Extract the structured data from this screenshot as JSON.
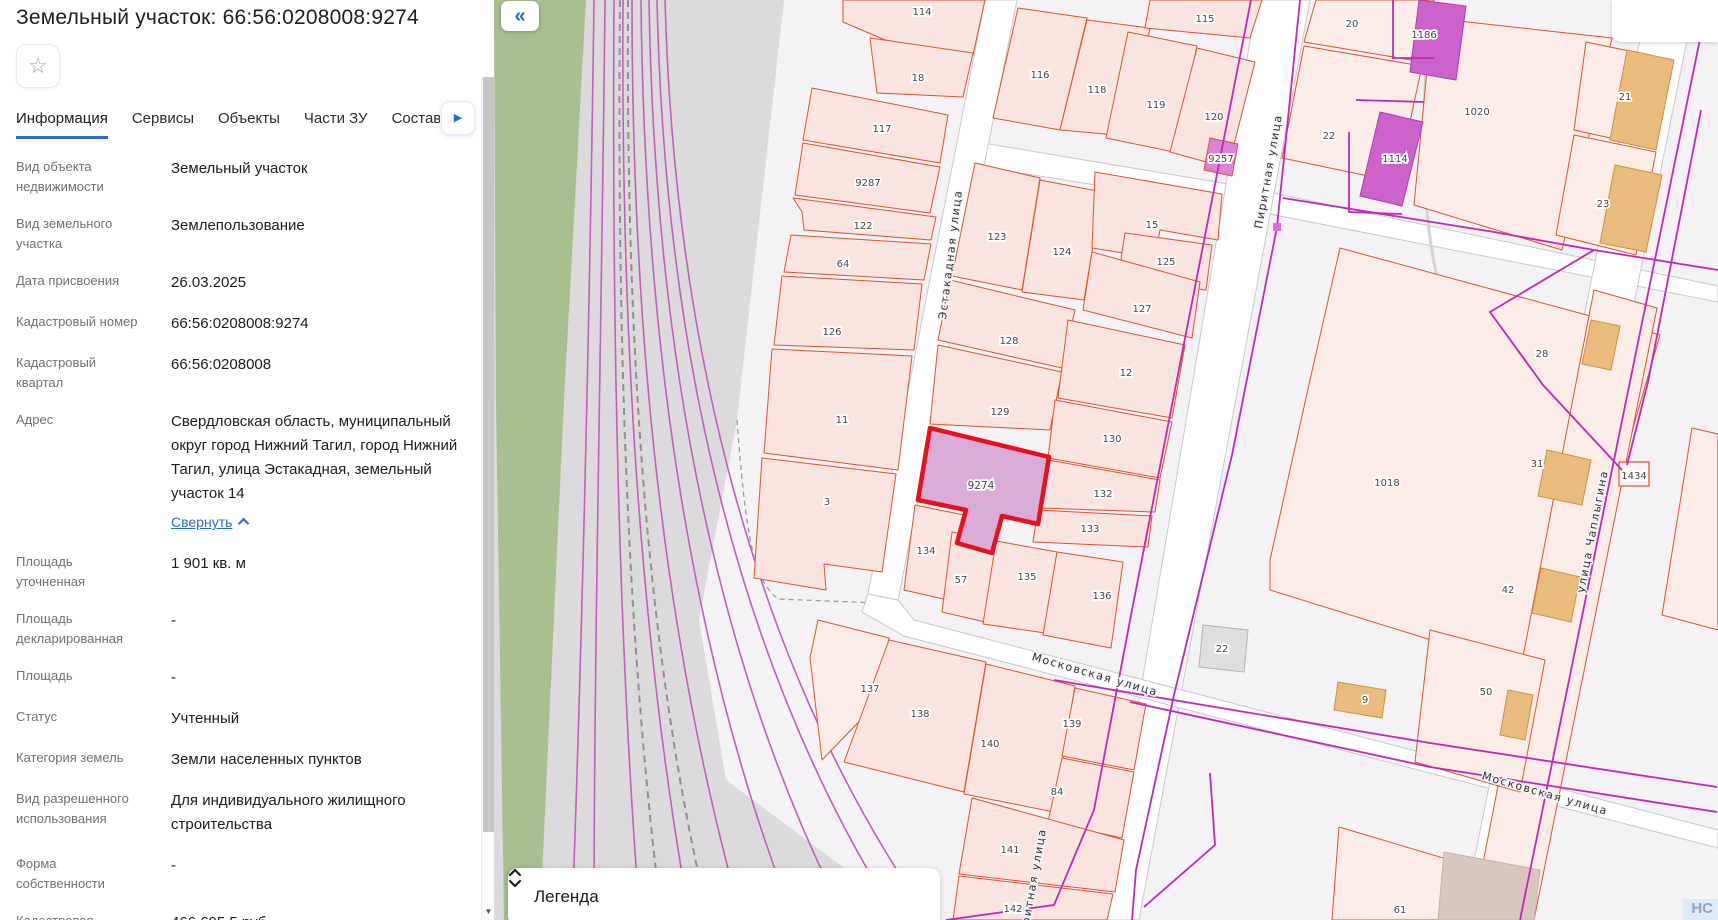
{
  "panel": {
    "title": "Земельный участок: 66:56:0208008:9274",
    "star_icon": "☆",
    "tabs": [
      {
        "label": "Информация",
        "active": true
      },
      {
        "label": "Сервисы",
        "active": false
      },
      {
        "label": "Объекты",
        "active": false
      },
      {
        "label": "Части ЗУ",
        "active": false
      },
      {
        "label": "Состав ЕЗП",
        "active": false
      }
    ],
    "fields": [
      {
        "label": "Вид объекта недвижимости",
        "value": "Земельный участок"
      },
      {
        "label": "Вид земельного участка",
        "value": "Землепользование"
      },
      {
        "label": "Дата присвоения",
        "value": "26.03.2025"
      },
      {
        "label": "Кадастровый номер",
        "value": "66:56:0208008:9274"
      },
      {
        "label": "Кадастровый квартал",
        "value": "66:56:0208008"
      },
      {
        "label": "Адрес",
        "value": "Свердловская область, муниципальный округ город Нижний Тагил, город Нижний Тагил, улица Эстакадная, земельный участок 14",
        "link": "Свернуть"
      },
      {
        "label": "Площадь уточненная",
        "value": "1 901 кв. м"
      },
      {
        "label": "Площадь декларированная",
        "value": "-"
      },
      {
        "label": "Площадь",
        "value": "-"
      },
      {
        "label": "Статус",
        "value": "Учтенный"
      },
      {
        "label": "Категория земель",
        "value": "Земли населенных пунктов"
      },
      {
        "label": "Вид разрешенного использования",
        "value": "Для индивидуального жилищного строительства"
      },
      {
        "label": "Форма собственности",
        "value": "-"
      },
      {
        "label": "Кадастровая стоимость",
        "value": "466 695,5 руб."
      }
    ]
  },
  "map": {
    "collapse_button": "«",
    "legend_title": "Легенда",
    "watermark": "НС",
    "colors": {
      "bg": "#f4f2f4",
      "road": "#ffffff",
      "road_stroke": "#c9c7cc",
      "parcel": "#f9e4e0",
      "parcel_alt": "#fbece7",
      "parcel_stroke": "#e0512f",
      "selected_fill": "#d9abd7",
      "selected_stroke": "#e5111f",
      "magenta_bld": "#ce62cc",
      "magenta_bld_stroke": "#ab3fa9",
      "magenta_parcel": "#d983d7",
      "tan": "#e9bc7e",
      "tan_stroke": "#c8913f",
      "gray_bld": "#dfdfdf",
      "gray_bld_stroke": "#b3b3b3",
      "mauve": "#d9c6c0",
      "mauve_stroke": "#c9b3ac",
      "green": "#a8bf90",
      "rail_area": "#dcdadd",
      "rail": "#c05fb6",
      "rail_dash": "#8f8f8f",
      "utility": "#c227ba",
      "label": "#474747",
      "street_label": "#303030"
    },
    "areas": {
      "rail_corridor": "60,0 290,0 243,420 205,620 232,780 420,920 0,920 0,0",
      "green": "0,0 92,0 70,400 46,920 10,920 2,400"
    },
    "streets": [
      {
        "pts": "489,143 740,185 1224,286 1224,302 740,207 489,167"
      },
      {
        "pts": "491,0 523,0 404,600 374,594"
      },
      {
        "pts": "763,0 816,0 645,920 608,920"
      },
      {
        "pts": "374,594 404,600 420,620 1224,830 1224,848 410,636 368,612"
      },
      {
        "pts": "1154,0 1201,0 1016,920 968,920"
      }
    ],
    "parcels": [
      {
        "n": "114",
        "pts": "349,0 491,0 479,55 391,40 349,22",
        "lx": 428,
        "ly": 12
      },
      {
        "n": "18",
        "pts": "376,38 479,53 469,97 383,93",
        "lx": 424,
        "ly": 78
      },
      {
        "n": "117",
        "pts": "318,88 454,115 446,163 309,140",
        "lx": 388,
        "ly": 129
      },
      {
        "n": "9287",
        "pts": "309,143 446,167 436,213 301,195",
        "lx": 374,
        "ly": 183
      },
      {
        "n": "122",
        "pts": "299,198 442,217 437,240 310,230 308,212",
        "lx": 369,
        "ly": 226
      },
      {
        "n": "64",
        "pts": "297,235 437,244 430,280 290,272",
        "lx": 349,
        "ly": 264
      },
      {
        "n": "126",
        "pts": "288,276 428,284 420,350 280,345",
        "lx": 338,
        "ly": 332
      },
      {
        "n": "11",
        "pts": "278,349 418,356 404,470 270,453",
        "lx": 348,
        "ly": 420
      },
      {
        "n": "3",
        "pts": "268,458 402,474 388,572 330,564 332,590 260,578",
        "lx": 333,
        "ly": 502
      },
      {
        "n": "116",
        "pts": "524,8 593,18 566,130 499,118",
        "lx": 546,
        "ly": 75
      },
      {
        "n": "118",
        "pts": "593,20 656,28 634,136 566,130",
        "lx": 603,
        "ly": 90
      },
      {
        "n": "115",
        "pts": "656,0 768,0 756,38 651,28",
        "lx": 711,
        "ly": 19
      },
      {
        "n": "119",
        "pts": "634,32 703,46 680,152 612,138",
        "lx": 662,
        "ly": 105
      },
      {
        "n": "120",
        "pts": "703,48 761,62 734,168 676,152",
        "lx": 720,
        "ly": 117
      },
      {
        "n": "9257",
        "pts": "716,138 744,144 738,176 710,170",
        "lx": 727,
        "ly": 159,
        "mag": true
      },
      {
        "n": "123",
        "pts": "481,163 546,178 528,290 458,276",
        "lx": 503,
        "ly": 237
      },
      {
        "n": "124",
        "pts": "546,180 608,192 590,300 528,292",
        "lx": 568,
        "ly": 252
      },
      {
        "n": "15",
        "pts": "601,172 728,194 724,240 666,230 661,258 598,248",
        "lx": 658,
        "ly": 225
      },
      {
        "n": "125",
        "pts": "631,233 718,245 712,290 624,278",
        "lx": 672,
        "ly": 262
      },
      {
        "n": "127",
        "pts": "598,252 706,282 698,338 589,310",
        "lx": 648,
        "ly": 309
      },
      {
        "n": "128",
        "pts": "456,280 581,310 568,368 444,340",
        "lx": 515,
        "ly": 341
      },
      {
        "n": "129",
        "pts": "444,345 568,372 556,430 436,424",
        "lx": 506,
        "ly": 412
      },
      {
        "n": "12",
        "pts": "574,320 691,345 678,418 564,398",
        "lx": 632,
        "ly": 373
      },
      {
        "n": "130",
        "pts": "561,400 678,422 666,478 554,458",
        "lx": 618,
        "ly": 439
      },
      {
        "n": "132",
        "pts": "554,460 666,480 661,512 546,508",
        "lx": 609,
        "ly": 494
      },
      {
        "n": "133",
        "pts": "544,510 658,516 654,547 539,542",
        "lx": 596,
        "ly": 529
      },
      {
        "n": "134",
        "pts": "421,505 470,515 458,601 410,590",
        "lx": 432,
        "ly": 551
      },
      {
        "n": "57",
        "pts": "458,532 502,541 491,622 448,612",
        "lx": 467,
        "ly": 580
      },
      {
        "n": "135",
        "pts": "502,541 563,552 551,633 489,624",
        "lx": 533,
        "ly": 577
      },
      {
        "n": "136",
        "pts": "563,552 629,562 617,648 549,635",
        "lx": 608,
        "ly": 596
      },
      {
        "n": "137",
        "pts": "324,620 395,638 384,702 328,760 316,658",
        "lx": 376,
        "ly": 689,
        "alt": true
      },
      {
        "n": "138",
        "pts": "395,640 492,662 470,792 350,762",
        "lx": 426,
        "ly": 714
      },
      {
        "n": "140",
        "pts": "492,664 581,686 560,812 470,794",
        "lx": 496,
        "ly": 744
      },
      {
        "n": "139",
        "pts": "581,688 652,704 640,770 568,756",
        "lx": 578,
        "ly": 724
      },
      {
        "n": "84",
        "pts": "568,758 640,772 628,838 554,822",
        "lx": 563,
        "ly": 792
      },
      {
        "n": "141",
        "pts": "478,798 630,840 621,892 465,874",
        "lx": 516,
        "ly": 850
      },
      {
        "n": "142",
        "pts": "465,876 619,894 613,920 459,920",
        "lx": 519,
        "ly": 909
      },
      {
        "n": "20",
        "pts": "822,0 940,0 929,62 810,42",
        "lx": 858,
        "ly": 24,
        "alt": true
      },
      {
        "n": "22",
        "pts": "810,46 928,66 903,182 788,158",
        "lx": 835,
        "ly": 136,
        "alt": true
      },
      {
        "n": "1020",
        "pts": "938,18 1118,38 1068,250 920,205",
        "lx": 983,
        "ly": 112,
        "alt": true
      },
      {
        "n": "21",
        "pts": "1092,42 1178,60 1162,148 1080,130",
        "lx": 1131,
        "ly": 97,
        "alt": true
      },
      {
        "n": "23",
        "pts": "1080,135 1162,152 1142,255 1062,235",
        "lx": 1109,
        "ly": 204,
        "alt": true
      },
      {
        "n": "1018",
        "pts": "846,248 1166,335 1066,680 776,590 776,560 816,380",
        "lx": 893,
        "ly": 483,
        "alt": true
      },
      {
        "n": "",
        "pts": "1100,290 1163,308 1040,920 978,920",
        "lx": 0,
        "ly": 0,
        "alt": true
      },
      {
        "n": "50",
        "pts": "936,630 1051,660 1026,792 921,762",
        "lx": 992,
        "ly": 692,
        "alt": true
      },
      {
        "n": "61",
        "pts": "845,827 1030,882 1022,920 838,920",
        "lx": 906,
        "ly": 910,
        "alt": true
      },
      {
        "n": "",
        "pts": "1198,428 1224,434 1224,630 1168,615",
        "lx": 0,
        "ly": 0,
        "alt": true
      },
      {
        "n": "9274",
        "pts": "436,428 555,457 544,524 508,516 498,553 463,543 472,510 424,500",
        "lx": 487,
        "ly": 486,
        "sel": true
      }
    ],
    "buildings": [
      {
        "pts": "1133,50 1180,60 1162,150 1116,140",
        "type": "tan"
      },
      {
        "pts": "1121,165 1168,175 1152,252 1106,243",
        "type": "tan"
      },
      {
        "pts": "844,682 892,690 888,718 840,710",
        "type": "tan"
      },
      {
        "pts": "1097,320 1126,326 1117,370 1088,364",
        "type": "tan"
      },
      {
        "pts": "1053,450 1097,460 1088,505 1044,496",
        "type": "tan"
      },
      {
        "pts": "1047,568 1086,577 1077,622 1038,613",
        "type": "tan"
      },
      {
        "pts": "1014,690 1039,695 1031,740 1006,735",
        "type": "tan"
      },
      {
        "pts": "925,0 972,6 962,80 916,72",
        "type": "magenta"
      },
      {
        "pts": "886,112 929,122 908,206 866,196",
        "type": "magenta"
      },
      {
        "pts": "709,625 754,630 750,672 705,667",
        "type": "gray"
      },
      {
        "pts": "950,852 1046,870 1040,920 944,920",
        "type": "mauve"
      }
    ],
    "extra_labels": [
      {
        "n": "1186",
        "x": 930,
        "y": 35
      },
      {
        "n": "1114",
        "x": 901,
        "y": 159
      },
      {
        "n": "28",
        "x": 1048,
        "y": 354
      },
      {
        "n": "31",
        "x": 1043,
        "y": 464
      },
      {
        "n": "42",
        "x": 1014,
        "y": 590
      },
      {
        "n": "1434",
        "x": 1140,
        "y": 476
      },
      {
        "n": "22",
        "x": 728,
        "y": 649
      },
      {
        "n": "9",
        "x": 871,
        "y": 700
      }
    ],
    "rail_lines": [
      "M100,0 C96,300 88,650 78,920",
      "M111,0 C108,300 100,650 100,920",
      "M120,0 C118,320 124,640 146,920",
      "M129,0 C127,300 142,620 196,920",
      "M138,0 C138,300 163,620 248,920",
      "M147,0 C150,300 186,630 300,920",
      "M155,0 C160,310 208,640 352,920",
      "M163,0 C170,320 232,650 404,920",
      "M171,0 C180,330 254,660 436,920"
    ],
    "rail_dashed": [
      "M126,0 C123,320 132,640 168,920",
      "M134,0 C132,330 150,650 215,920"
    ],
    "boundary_dashed": "M243,420 C252,540 260,580 284,599 L384,603",
    "utility_lines": [
      "M757,0 L638,610 L600,810 L560,905 L452,920",
      "M806,0 L783,227 L738,455 L680,695 L642,870 L638,920",
      "M789,198 L1000,232 L1100,250 L1224,270",
      "M1100,250 L996,312 L1049,385 L1128,470",
      "M1214,0 L1026,920",
      "M1207,110 L1154,382 L1133,465",
      "M560,680 L936,743 L1223,787",
      "M636,702 L936,767 L1223,812",
      "M899,0 L899,58 L940,58",
      "M862,100 L930,102",
      "M855,132 L855,212 L908,214",
      "M716,773 L721,845 L650,907"
    ],
    "service_paths": [
      "M846,920 Q904,868 1032,884",
      "M934,40 C924,160 930,330 986,345"
    ],
    "node": {
      "x": 779,
      "y": 223,
      "w": 8,
      "h": 8
    },
    "box_1434": {
      "x": 1125,
      "y": 462,
      "w": 30,
      "h": 24
    },
    "street_labels": [
      {
        "text": "Эстакадная улица",
        "x": 460,
        "y": 255,
        "r": -83
      },
      {
        "text": "Пиритная улица",
        "x": 778,
        "y": 172,
        "r": -80
      },
      {
        "text": "Пиритная улица",
        "x": 542,
        "y": 886,
        "r": -80
      },
      {
        "text": "Московская улица",
        "x": 600,
        "y": 678,
        "r": 16
      },
      {
        "text": "Московская улица",
        "x": 1050,
        "y": 797,
        "r": 16
      },
      {
        "text": "улица Чаплыгина",
        "x": 1102,
        "y": 532,
        "r": -79
      }
    ]
  }
}
